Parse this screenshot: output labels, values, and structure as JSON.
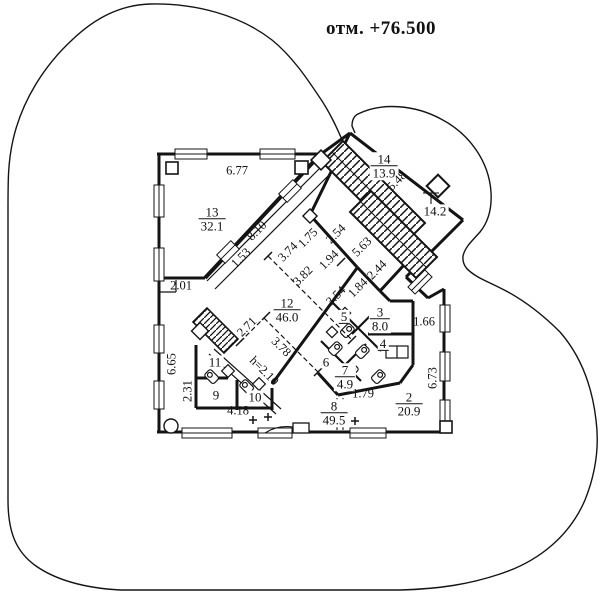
{
  "drawing": {
    "title": "отм. +76.500",
    "type_note": "floor plan with site outline curve"
  },
  "colors": {
    "line": "#141414",
    "background": "#ffffff"
  },
  "labels": [
    {
      "kind": "room",
      "text": "13",
      "area": "32.1",
      "x": 212,
      "y": 219,
      "rot": 0
    },
    {
      "kind": "room",
      "text": "12",
      "area": "46.0",
      "x": 287,
      "y": 310,
      "rot": 0
    },
    {
      "kind": "room",
      "text": "14",
      "area": "13.9",
      "x": 384,
      "y": 166,
      "rot": 0
    },
    {
      "kind": "room",
      "text": "3",
      "area": "8.0",
      "x": 380,
      "y": 319,
      "rot": 0
    },
    {
      "kind": "room",
      "text": "7",
      "area": "4.9",
      "x": 345,
      "y": 377,
      "rot": 0
    },
    {
      "kind": "room",
      "text": "8",
      "area": "49.5",
      "x": 334,
      "y": 413,
      "rot": 0
    },
    {
      "kind": "room",
      "text": "2",
      "area": "20.9",
      "x": 409,
      "y": 404,
      "rot": 0
    },
    {
      "kind": "single",
      "text": "5",
      "x": 344,
      "y": 317,
      "rot": 0,
      "ul": true
    },
    {
      "kind": "single",
      "text": "4",
      "x": 383,
      "y": 344,
      "rot": 0,
      "ul": true
    },
    {
      "kind": "single",
      "text": "6",
      "x": 326,
      "y": 362,
      "rot": 0,
      "ul": false
    },
    {
      "kind": "single",
      "text": "11",
      "x": 215,
      "y": 362,
      "rot": 0,
      "ul": false
    },
    {
      "kind": "single",
      "text": "9",
      "x": 216,
      "y": 395,
      "rot": 0,
      "ul": false
    },
    {
      "kind": "single",
      "text": "10",
      "x": 255,
      "y": 397,
      "rot": 0,
      "ul": false
    },
    {
      "kind": "single",
      "text": "14.2",
      "x": 435,
      "y": 211,
      "rot": 0,
      "ul": false
    },
    {
      "kind": "dim",
      "text": "6.77",
      "x": 237,
      "y": 171,
      "rot": 0
    },
    {
      "kind": "dim",
      "text": "2.01",
      "x": 181,
      "y": 286,
      "rot": 0
    },
    {
      "kind": "dim",
      "text": "1.66",
      "x": 424,
      "y": 322,
      "rot": 0
    },
    {
      "kind": "dim",
      "text": "4.18",
      "x": 238,
      "y": 411,
      "rot": 0
    },
    {
      "kind": "dim",
      "text": "1.79",
      "x": 363,
      "y": 394,
      "rot": 0
    },
    {
      "kind": "dim",
      "text": "6.65",
      "x": 172,
      "y": 364,
      "rot": -90
    },
    {
      "kind": "dim",
      "text": "2.31",
      "x": 188,
      "y": 391,
      "rot": -90
    },
    {
      "kind": "dim",
      "text": "6.73",
      "x": 433,
      "y": 378,
      "rot": -90
    },
    {
      "kind": "dim",
      "text": "8.10",
      "x": 257,
      "y": 231,
      "rot": -45
    },
    {
      "kind": "dim",
      "text": "1.53",
      "x": 241,
      "y": 258,
      "rot": -45
    },
    {
      "kind": "dim",
      "text": "3.74",
      "x": 288,
      "y": 252,
      "rot": -45
    },
    {
      "kind": "dim",
      "text": "1.75",
      "x": 308,
      "y": 238,
      "rot": -45
    },
    {
      "kind": "dim",
      "text": "1.94",
      "x": 329,
      "y": 260,
      "rot": -45
    },
    {
      "kind": "dim",
      "text": "2.54",
      "x": 336,
      "y": 234,
      "rot": -45
    },
    {
      "kind": "dim",
      "text": "5.63",
      "x": 362,
      "y": 247,
      "rot": -45
    },
    {
      "kind": "dim",
      "text": "2.44",
      "x": 377,
      "y": 270,
      "rot": -45
    },
    {
      "kind": "dim",
      "text": "1.84",
      "x": 358,
      "y": 288,
      "rot": -45
    },
    {
      "kind": "dim",
      "text": "3.82",
      "x": 303,
      "y": 276,
      "rot": -45
    },
    {
      "kind": "dim",
      "text": "3.54",
      "x": 336,
      "y": 296,
      "rot": -45
    },
    {
      "kind": "dim",
      "text": "2.71",
      "x": 247,
      "y": 327,
      "rot": -45
    },
    {
      "kind": "dim",
      "text": "5.48",
      "x": 397,
      "y": 181,
      "rot": -45
    },
    {
      "kind": "dim",
      "text": "3.78",
      "x": 281,
      "y": 347,
      "rot": 45
    },
    {
      "kind": "dim",
      "text": "h=2.10",
      "x": 264,
      "y": 371,
      "rot": 45
    }
  ]
}
